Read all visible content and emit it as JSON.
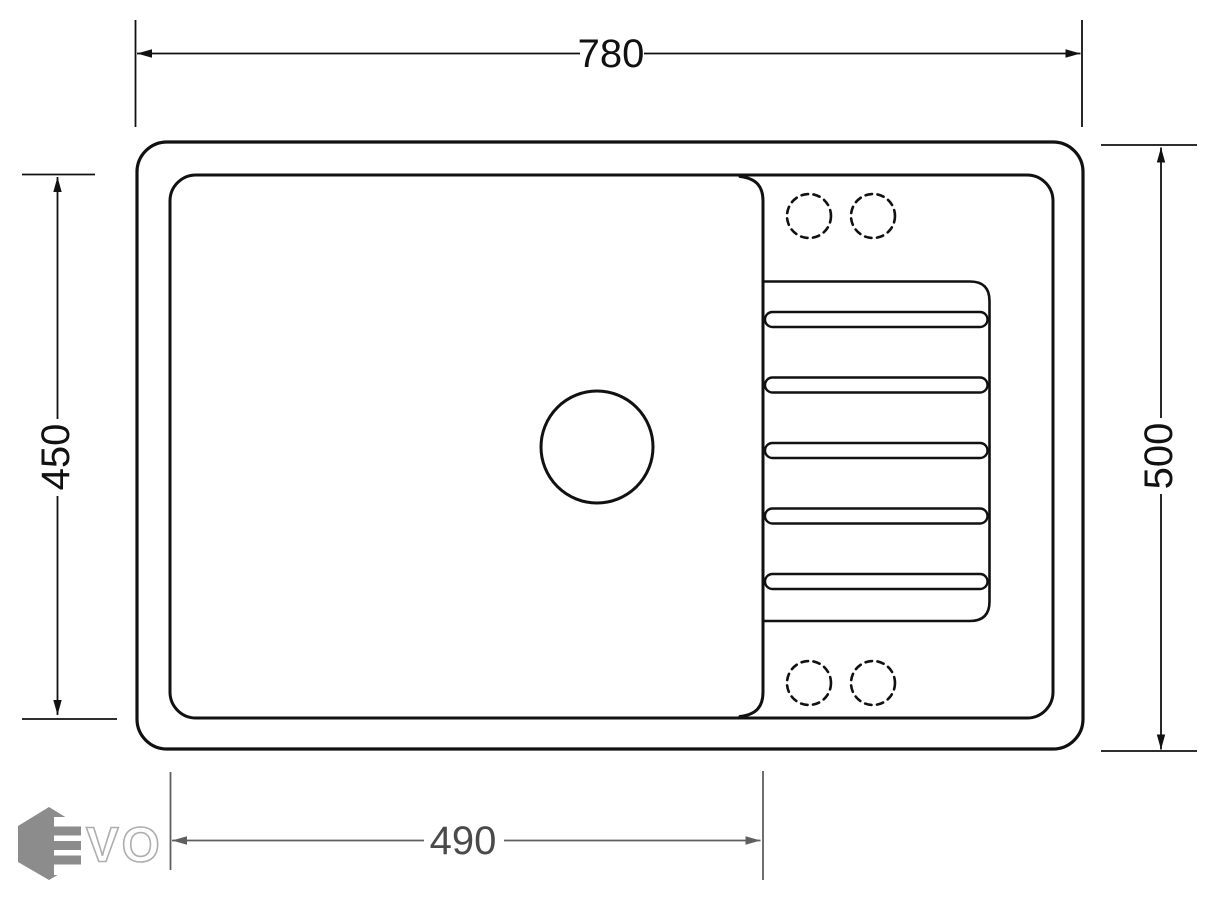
{
  "drawing": {
    "dimensions": {
      "overall_width": "780",
      "overall_depth": "500",
      "bowl_depth": "450",
      "bowl_width": "490"
    },
    "features": {
      "tap_holes": 4,
      "drainer_grooves": 5,
      "drain_holes": 1
    }
  },
  "logo": {
    "brand": "EVO",
    "outlined_letters": "VO"
  },
  "colors": {
    "outline": "#111111",
    "dimension_primary": "#111111",
    "dimension_secondary": "#5f5f5f",
    "logo_gray": "#8c8c8c",
    "background": "#ffffff"
  }
}
